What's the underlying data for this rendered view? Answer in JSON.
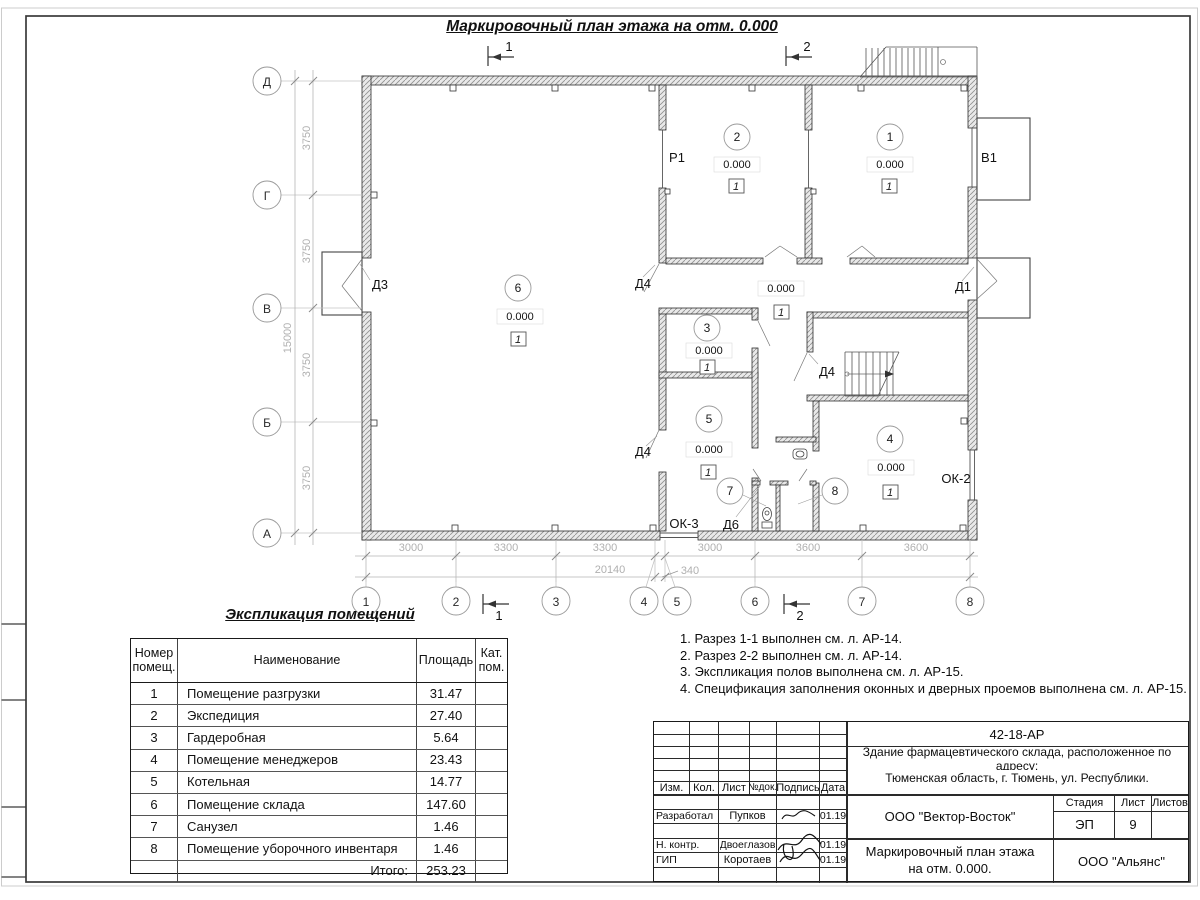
{
  "sheet": {
    "title": "Маркировочный план этажа на отм. 0.000"
  },
  "plan": {
    "axes_left": [
      "Д",
      "Г",
      "В",
      "Б",
      "А"
    ],
    "axes_bottom": [
      "1",
      "2",
      "3",
      "4",
      "5",
      "6",
      "7",
      "8"
    ],
    "dims_left": [
      "3750",
      "3750",
      "3750",
      "3750"
    ],
    "dim_total_left": "15000",
    "dims_bottom": [
      "3000",
      "3300",
      "3300",
      "3000",
      "3600",
      "3600"
    ],
    "dim_340": "340",
    "dim_total_bottom": "20140",
    "section1": "1",
    "section2": "2",
    "rooms": [
      {
        "num": "1",
        "elev": "0.000",
        "floor": "1"
      },
      {
        "num": "2",
        "elev": "0.000",
        "floor": "1"
      },
      {
        "num": "3",
        "elev": "0.000",
        "floor": "1"
      },
      {
        "num": "4",
        "elev": "0.000",
        "floor": "1"
      },
      {
        "num": "5",
        "elev": "0.000",
        "floor": "1"
      },
      {
        "num": "6",
        "elev": "0.000",
        "floor": "1"
      },
      {
        "num": "7"
      },
      {
        "num": "8"
      }
    ],
    "corridor": {
      "elev": "0.000",
      "floor": "1"
    },
    "openings": {
      "d1": "Д1",
      "d3": "Д3",
      "d4": "Д4",
      "d6": "Д6",
      "p1": "Р1",
      "v1": "В1",
      "ok2": "ОК-2",
      "ok3": "ОК-3"
    }
  },
  "explication": {
    "title": "Экспликация помещений",
    "headers": [
      "Номер помещ.",
      "Наименование",
      "Площадь",
      "Кат. пом."
    ],
    "rows": [
      [
        "1",
        "Помещение разгрузки",
        "31.47"
      ],
      [
        "2",
        "Экспедиция",
        "27.40"
      ],
      [
        "3",
        "Гардеробная",
        "5.64"
      ],
      [
        "4",
        "Помещение менеджеров",
        "23.43"
      ],
      [
        "5",
        "Котельная",
        "14.77"
      ],
      [
        "6",
        "Помещение склада",
        "147.60"
      ],
      [
        "7",
        "Санузел",
        "1.46"
      ],
      [
        "8",
        "Помещение уборочного инвентаря",
        "1.46"
      ]
    ],
    "total_label": "Итого:",
    "total": "253.23"
  },
  "notes": [
    "1. Разрез 1-1 выполнен см. л. АР-14.",
    "2. Разрез 2-2 выполнен см. л. АР-14.",
    "3. Экспликация полов выполнена см. л. АР-15.",
    "4. Спецификация заполнения оконных и дверных проемов выполнена см. л. АР-15."
  ],
  "stamp": {
    "doc_number": "42-18-АР",
    "project_line1": "Здание фармацевтического склада, расположенное по адресу:",
    "project_line2": "Тюменская область, г. Тюмень, ул. Республики.",
    "header_cells": [
      "Изм.",
      "Кол.",
      "Лист",
      "№док.",
      "Подпись",
      "Дата"
    ],
    "rows": [
      {
        "role": "Разработал",
        "name": "Пупков",
        "date": "01.19"
      },
      {
        "role": "Н. контр.",
        "name": "Двоеглазов",
        "date": "01.19"
      },
      {
        "role": "ГИП",
        "name": "Коротаев",
        "date": "01.19"
      }
    ],
    "org": "ООО \"Вектор-Восток\"",
    "stage_label": "Стадия",
    "sheet_label": "Лист",
    "sheets_label": "Листов",
    "stage": "ЭП",
    "sheet_num": "9",
    "drawing_title_line1": "Маркировочный план этажа",
    "drawing_title_line2": "на отм. 0.000.",
    "company": "ООО \"Альянс\""
  }
}
